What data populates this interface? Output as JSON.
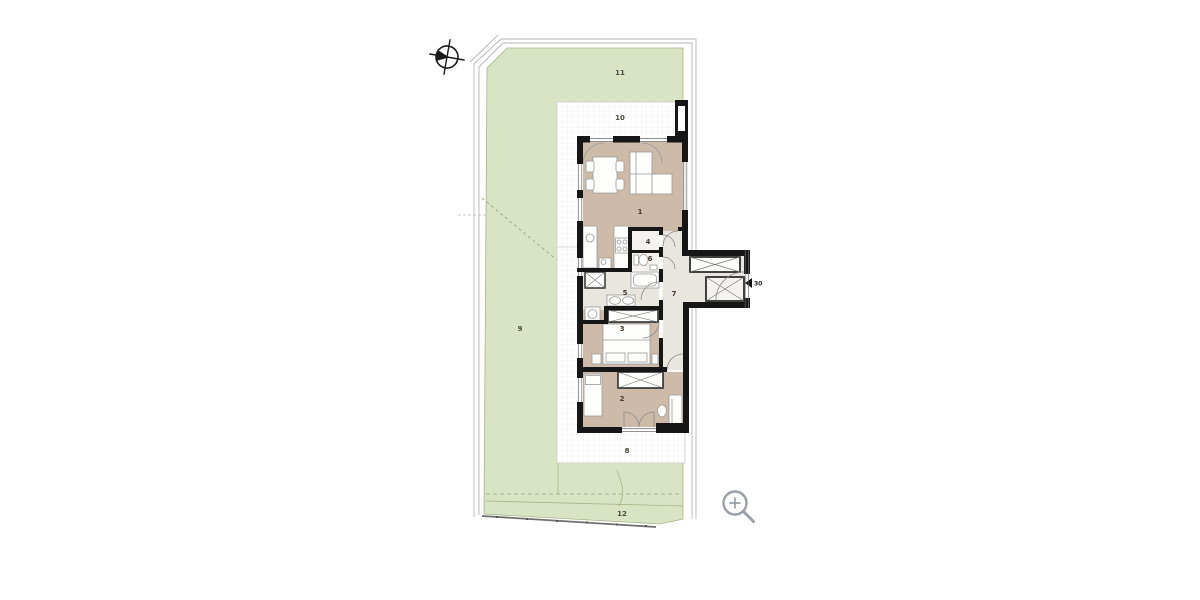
{
  "document": {
    "type": "architectural-site-and-floor-plan",
    "background": "#ffffff"
  },
  "labels": {
    "room1": "1",
    "room2": "2",
    "room3": "3",
    "room4": "4",
    "room5": "5",
    "room6": "6",
    "room7": "7",
    "area8": "8",
    "area9": "9",
    "area10": "10",
    "area11": "11",
    "area12": "12",
    "unit": "30"
  },
  "icons": {
    "compass": "north-arrow",
    "magnifier": "zoom-in"
  },
  "colors": {
    "site_green": "#d9e4c4",
    "site_green_edge": "#a9b489",
    "floor_tan": "#cdbaa9",
    "floor_gray": "#e9e6e0",
    "floor_white": "#f4f3ef",
    "wall_black": "#161616",
    "terrace_grid": "#e4e4e4",
    "boundary_line": "#b5b5b5",
    "icon_gray": "#9aa0a6",
    "label_dark": "#46392e"
  }
}
